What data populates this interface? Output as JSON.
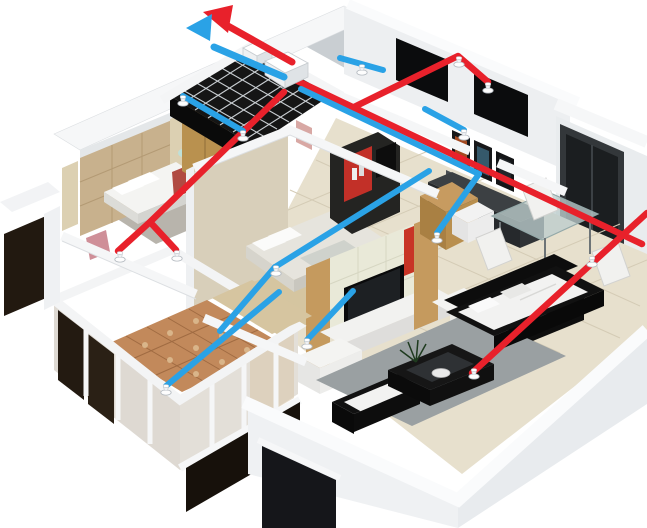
{
  "scene": {
    "type": "3d-isometric-apartment-cutaway",
    "rooms": [
      "bedroom-1",
      "bathroom",
      "bedroom-2",
      "study",
      "dining-area",
      "living-room",
      "balcony",
      "hallway"
    ],
    "equipment": [
      "ventilation-unit"
    ]
  },
  "colors": {
    "background": "#ffffff",
    "duct_red": "#e8212b",
    "duct_blue": "#2aa2e6",
    "vent_white": "#fdfdfd",
    "wall_white": "#f5f6f7",
    "floor_tile": "#e7e0cd",
    "wood": "#c59a5e",
    "balcony_tile": "#c2895b",
    "glass_dark": "#17110b",
    "rug_gray": "#9aa0a2",
    "sofa_black": "#111111",
    "cushion_white": "#f2f2f1",
    "bathroom_tile": "#151515"
  },
  "ventilation": {
    "arrows": {
      "red": {
        "shaft": [
          [
            292,
            62
          ],
          [
            228,
            26
          ]
        ],
        "head": [
          [
            203,
            12
          ],
          [
            233,
            5
          ],
          [
            228,
            33
          ]
        ]
      },
      "blue": {
        "shaft": [
          [
            284,
            77
          ],
          [
            214,
            47
          ]
        ],
        "head": [
          [
            186,
            28
          ],
          [
            212,
            14
          ],
          [
            210,
            41
          ]
        ]
      }
    },
    "red_ducts": [
      [
        [
          287,
          76
        ],
        [
          642,
          244
        ]
      ],
      [
        [
          352,
          108
        ],
        [
          458,
          56
        ],
        [
          488,
          82
        ]
      ],
      [
        [
          284,
          92
        ],
        [
          150,
          222
        ],
        [
          118,
          251
        ]
      ],
      [
        [
          150,
          222
        ],
        [
          176,
          250
        ]
      ],
      [
        [
          647,
          213
        ],
        [
          472,
          373
        ]
      ]
    ],
    "blue_ducts": [
      [
        [
          183,
          96
        ],
        [
          243,
          131
        ]
      ],
      [
        [
          340,
          58
        ],
        [
          383,
          70
        ]
      ],
      [
        [
          301,
          89
        ],
        [
          479,
          174
        ]
      ],
      [
        [
          425,
          109
        ],
        [
          464,
          130
        ]
      ],
      [
        [
          479,
          174
        ],
        [
          437,
          233
        ]
      ],
      [
        [
          429,
          171
        ],
        [
          275,
          267
        ]
      ],
      [
        [
          275,
          267
        ],
        [
          220,
          331
        ]
      ],
      [
        [
          279,
          292
        ],
        [
          166,
          386
        ]
      ],
      [
        [
          353,
          291
        ],
        [
          307,
          340
        ]
      ]
    ],
    "vents": [
      {
        "x": 459,
        "y": 62,
        "line": "red"
      },
      {
        "x": 488,
        "y": 88,
        "line": "red"
      },
      {
        "x": 120,
        "y": 257,
        "line": "red"
      },
      {
        "x": 177,
        "y": 256,
        "line": "red"
      },
      {
        "x": 592,
        "y": 262,
        "line": "red"
      },
      {
        "x": 474,
        "y": 374,
        "line": "red"
      },
      {
        "x": 183,
        "y": 101,
        "line": "blue"
      },
      {
        "x": 243,
        "y": 136,
        "line": "blue"
      },
      {
        "x": 362,
        "y": 70,
        "line": "blue"
      },
      {
        "x": 464,
        "y": 135,
        "line": "blue"
      },
      {
        "x": 437,
        "y": 238,
        "line": "blue"
      },
      {
        "x": 276,
        "y": 271,
        "line": "blue"
      },
      {
        "x": 166,
        "y": 390,
        "line": "blue"
      },
      {
        "x": 307,
        "y": 344,
        "line": "blue"
      }
    ]
  }
}
